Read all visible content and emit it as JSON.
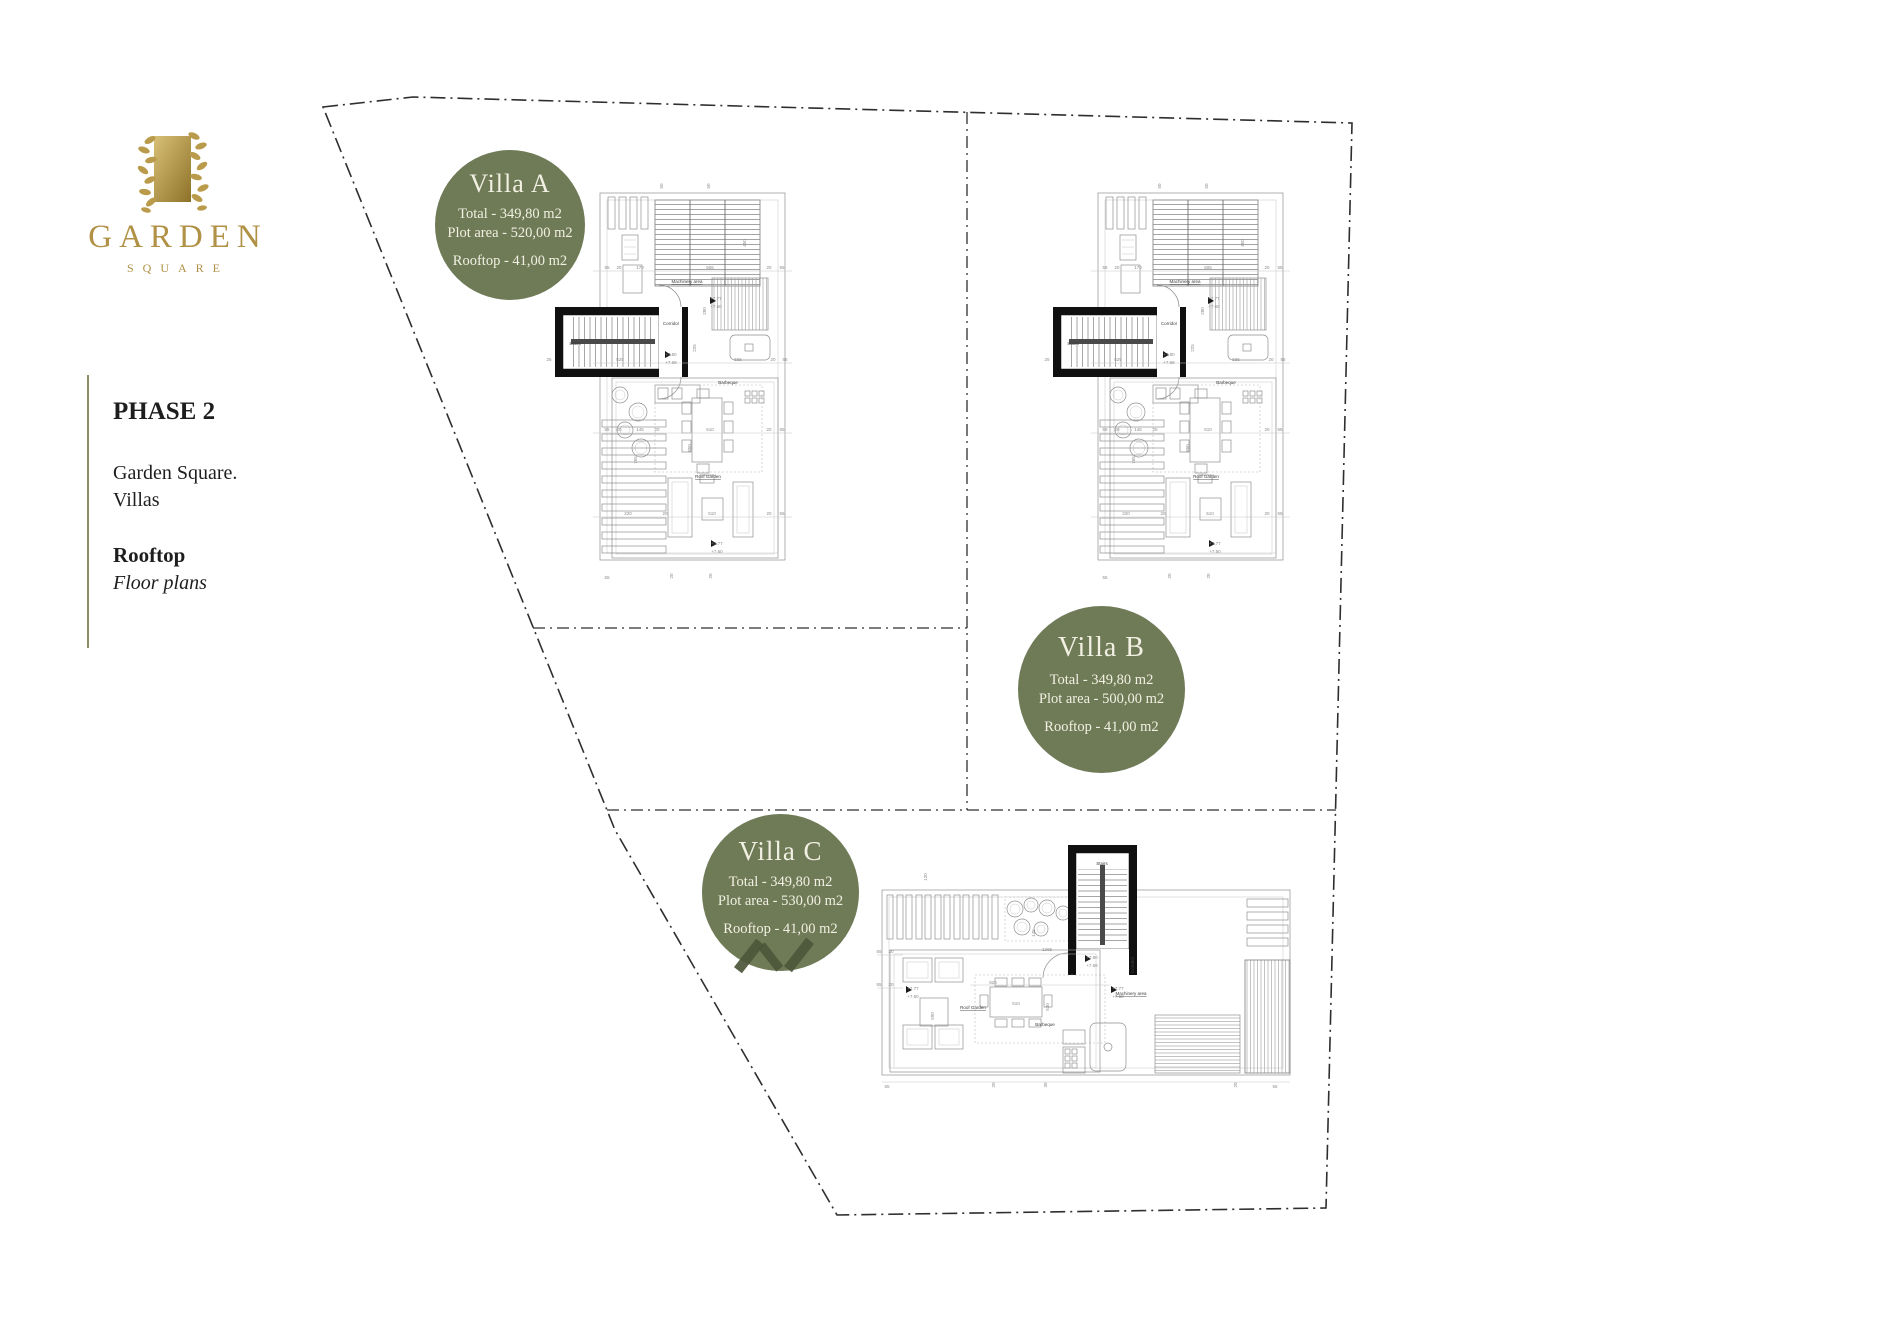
{
  "logo": {
    "brand": "GARDEN",
    "sub": "SQUARE",
    "gold": "#b09145"
  },
  "sidebar": {
    "phase": "PHASE 2",
    "line1": "Garden Square.",
    "line2": "Villas",
    "section": "Rooftop",
    "section_sub": "Floor plans"
  },
  "badge_color": "#6f7a57",
  "badges": [
    {
      "title": "Villa A",
      "total": "Total - 349,80 m2",
      "plot": "Plot area - 520,00 m2",
      "rooftop": "Rooftop - 41,00 m2"
    },
    {
      "title": "Villa B",
      "total": "Total - 349,80 m2",
      "plot": "Plot area - 500,00 m2",
      "rooftop": "Rooftop - 41,00 m2"
    },
    {
      "title": "Villa C",
      "total": "Total - 349,80 m2",
      "plot": "Plot area - 530,00 m2",
      "rooftop": "Rooftop - 41,00 m2"
    }
  ],
  "plans": {
    "villaA": {
      "items": [
        {
          "t": "50",
          "x": 118,
          "y": 38,
          "r": -90
        },
        {
          "t": "50",
          "x": 165,
          "y": 38,
          "r": -90
        },
        {
          "t": "55",
          "x": 62,
          "y": 121
        },
        {
          "t": "20",
          "x": 74,
          "y": 121
        },
        {
          "t": "170",
          "x": 95,
          "y": 121
        },
        {
          "t": "506",
          "x": 165,
          "y": 121
        },
        {
          "t": "20",
          "x": 224,
          "y": 121
        },
        {
          "t": "55",
          "x": 237,
          "y": 121
        },
        {
          "t": "450",
          "x": 201,
          "y": 95,
          "r": -90
        },
        {
          "t": "Machinery area",
          "x": 142,
          "y": 135,
          "cls": "lbl",
          "s": 4.8,
          "u": true
        },
        {
          "t": "280",
          "x": 161,
          "y": 163,
          "r": -90
        },
        {
          "t": "+7.77",
          "x": 171,
          "y": 152,
          "a": "start",
          "s": 4.2
        },
        {
          "t": "+7.60",
          "x": 171,
          "y": 160,
          "a": "start",
          "s": 4.2
        },
        {
          "t": "Stairs",
          "x": 30,
          "y": 197,
          "cls": "lbl",
          "s": 4.6
        },
        {
          "t": "Corridor",
          "x": 126,
          "y": 177,
          "cls": "lbl",
          "s": 4.2
        },
        {
          "t": "25",
          "x": 4,
          "y": 213
        },
        {
          "t": "525",
          "x": 75,
          "y": 213
        },
        {
          "t": "225",
          "x": 151,
          "y": 200,
          "r": -90
        },
        {
          "t": "+7.80",
          "x": 126,
          "y": 208,
          "a": "start",
          "s": 4.2
        },
        {
          "t": "+7.68",
          "x": 126,
          "y": 216,
          "a": "start",
          "s": 4.2
        },
        {
          "t": "565",
          "x": 193,
          "y": 213
        },
        {
          "t": "20",
          "x": 228,
          "y": 213
        },
        {
          "t": "55",
          "x": 240,
          "y": 213
        },
        {
          "t": "Barbeque",
          "x": 183,
          "y": 236,
          "cls": "lbl",
          "s": 4.8
        },
        {
          "t": "55",
          "x": 62,
          "y": 283
        },
        {
          "t": "20",
          "x": 74,
          "y": 283
        },
        {
          "t": "145",
          "x": 95,
          "y": 283
        },
        {
          "t": "20",
          "x": 112,
          "y": 283
        },
        {
          "t": "510",
          "x": 165,
          "y": 283
        },
        {
          "t": "20",
          "x": 224,
          "y": 283
        },
        {
          "t": "55",
          "x": 237,
          "y": 283
        },
        {
          "t": "765",
          "x": 92,
          "y": 312,
          "r": -90
        },
        {
          "t": "850",
          "x": 146,
          "y": 300,
          "r": -90
        },
        {
          "t": "Roof Garden",
          "x": 163,
          "y": 330,
          "cls": "lbl",
          "s": 4.8,
          "u": true
        },
        {
          "t": "220",
          "x": 83,
          "y": 367
        },
        {
          "t": "20",
          "x": 120,
          "y": 367
        },
        {
          "t": "510",
          "x": 167,
          "y": 367
        },
        {
          "t": "20",
          "x": 224,
          "y": 367
        },
        {
          "t": "55",
          "x": 237,
          "y": 367
        },
        {
          "t": "+7.77",
          "x": 172,
          "y": 397,
          "a": "start",
          "s": 4.2
        },
        {
          "t": "+7.60",
          "x": 172,
          "y": 405,
          "a": "start",
          "s": 4.2
        },
        {
          "t": "20",
          "x": 128,
          "y": 428,
          "r": -90
        },
        {
          "t": "20",
          "x": 167,
          "y": 428,
          "r": -90
        },
        {
          "t": "55",
          "x": 62,
          "y": 431
        }
      ]
    },
    "villaB": {
      "items": [
        {
          "t": "50",
          "x": 118,
          "y": 38,
          "r": -90
        },
        {
          "t": "50",
          "x": 165,
          "y": 38,
          "r": -90
        },
        {
          "t": "55",
          "x": 62,
          "y": 121
        },
        {
          "t": "20",
          "x": 74,
          "y": 121
        },
        {
          "t": "170",
          "x": 95,
          "y": 121
        },
        {
          "t": "506",
          "x": 165,
          "y": 121
        },
        {
          "t": "20",
          "x": 224,
          "y": 121
        },
        {
          "t": "55",
          "x": 237,
          "y": 121
        },
        {
          "t": "450",
          "x": 201,
          "y": 95,
          "r": -90
        },
        {
          "t": "Machinery area",
          "x": 142,
          "y": 135,
          "cls": "lbl",
          "s": 4.8,
          "u": true
        },
        {
          "t": "280",
          "x": 161,
          "y": 163,
          "r": -90
        },
        {
          "t": "+7.77",
          "x": 171,
          "y": 152,
          "a": "start",
          "s": 4.2
        },
        {
          "t": "+7.60",
          "x": 171,
          "y": 160,
          "a": "start",
          "s": 4.2
        },
        {
          "t": "Stairs",
          "x": 30,
          "y": 197,
          "cls": "lbl",
          "s": 4.6
        },
        {
          "t": "Corridor",
          "x": 126,
          "y": 177,
          "cls": "lbl",
          "s": 4.2
        },
        {
          "t": "25",
          "x": 4,
          "y": 213
        },
        {
          "t": "525",
          "x": 75,
          "y": 213
        },
        {
          "t": "225",
          "x": 151,
          "y": 200,
          "r": -90
        },
        {
          "t": "+7.80",
          "x": 126,
          "y": 208,
          "a": "start",
          "s": 4.2
        },
        {
          "t": "+7.68",
          "x": 126,
          "y": 216,
          "a": "start",
          "s": 4.2
        },
        {
          "t": "565",
          "x": 193,
          "y": 213
        },
        {
          "t": "20",
          "x": 228,
          "y": 213
        },
        {
          "t": "55",
          "x": 240,
          "y": 213
        },
        {
          "t": "Barbeque",
          "x": 183,
          "y": 236,
          "cls": "lbl",
          "s": 4.8
        },
        {
          "t": "55",
          "x": 62,
          "y": 283
        },
        {
          "t": "20",
          "x": 74,
          "y": 283
        },
        {
          "t": "145",
          "x": 95,
          "y": 283
        },
        {
          "t": "20",
          "x": 112,
          "y": 283
        },
        {
          "t": "510",
          "x": 165,
          "y": 283
        },
        {
          "t": "20",
          "x": 224,
          "y": 283
        },
        {
          "t": "55",
          "x": 237,
          "y": 283
        },
        {
          "t": "765",
          "x": 92,
          "y": 312,
          "r": -90
        },
        {
          "t": "850",
          "x": 146,
          "y": 300,
          "r": -90
        },
        {
          "t": "Roof Garden",
          "x": 163,
          "y": 330,
          "cls": "lbl",
          "s": 4.8,
          "u": true
        },
        {
          "t": "220",
          "x": 83,
          "y": 367
        },
        {
          "t": "20",
          "x": 120,
          "y": 367
        },
        {
          "t": "510",
          "x": 167,
          "y": 367
        },
        {
          "t": "20",
          "x": 224,
          "y": 367
        },
        {
          "t": "55",
          "x": 237,
          "y": 367
        },
        {
          "t": "+7.77",
          "x": 172,
          "y": 397,
          "a": "start",
          "s": 4.2
        },
        {
          "t": "+7.60",
          "x": 172,
          "y": 405,
          "a": "start",
          "s": 4.2
        },
        {
          "t": "20",
          "x": 128,
          "y": 428,
          "r": -90
        },
        {
          "t": "20",
          "x": 167,
          "y": 428,
          "r": -90
        },
        {
          "t": "55",
          "x": 62,
          "y": 431
        }
      ]
    },
    "villaC": {
      "items": [
        {
          "t": "120",
          "x": 52,
          "y": 42,
          "r": -90
        },
        {
          "t": "Stairs",
          "x": 227,
          "y": 30,
          "cls": "lbl",
          "s": 4.6
        },
        {
          "t": "+7.80",
          "x": 217,
          "y": 124,
          "a": "start",
          "s": 4.2
        },
        {
          "t": "+7.68",
          "x": 217,
          "y": 132,
          "a": "start",
          "s": 4.2
        },
        {
          "t": "Corridor",
          "x": 259,
          "y": 130,
          "r": -90,
          "cls": "lbl",
          "s": 4
        },
        {
          "t": "55",
          "x": 4,
          "y": 118
        },
        {
          "t": "20",
          "x": 16,
          "y": 118
        },
        {
          "t": "55",
          "x": 4,
          "y": 151
        },
        {
          "t": "20",
          "x": 16,
          "y": 151
        },
        {
          "t": "145",
          "x": 160,
          "y": 98,
          "r": -90
        },
        {
          "t": "1265",
          "x": 172,
          "y": 116
        },
        {
          "t": "820",
          "x": 118,
          "y": 149
        },
        {
          "t": "+7.77",
          "x": 38,
          "y": 155,
          "a": "start",
          "s": 4.2
        },
        {
          "t": "+7.60",
          "x": 38,
          "y": 163,
          "a": "start",
          "s": 4.2
        },
        {
          "t": "Roof Garden",
          "x": 98,
          "y": 174,
          "cls": "lbl",
          "s": 4.8,
          "u": true
        },
        {
          "t": "590",
          "x": 59,
          "y": 181,
          "r": -90
        },
        {
          "t": "510",
          "x": 141,
          "y": 170
        },
        {
          "t": "530",
          "x": 174,
          "y": 172,
          "r": -90
        },
        {
          "t": "Barbeque",
          "x": 170,
          "y": 191,
          "a": "start",
          "cls": "lbl",
          "s": 4.4
        },
        {
          "t": "+7.77",
          "x": 243,
          "y": 155,
          "a": "start",
          "s": 4.2
        },
        {
          "t": "+7.60",
          "x": 243,
          "y": 163,
          "a": "start",
          "s": 4.2
        },
        {
          "t": "Machinery area",
          "x": 256,
          "y": 160,
          "a": "start",
          "cls": "lbl",
          "s": 4.5,
          "u": true
        },
        {
          "t": "55",
          "x": 12,
          "y": 253
        },
        {
          "t": "20",
          "x": 120,
          "y": 250,
          "r": -90
        },
        {
          "t": "30",
          "x": 172,
          "y": 250,
          "r": -90
        },
        {
          "t": "20",
          "x": 362,
          "y": 250,
          "r": -90
        },
        {
          "t": "55",
          "x": 400,
          "y": 253
        }
      ]
    }
  }
}
